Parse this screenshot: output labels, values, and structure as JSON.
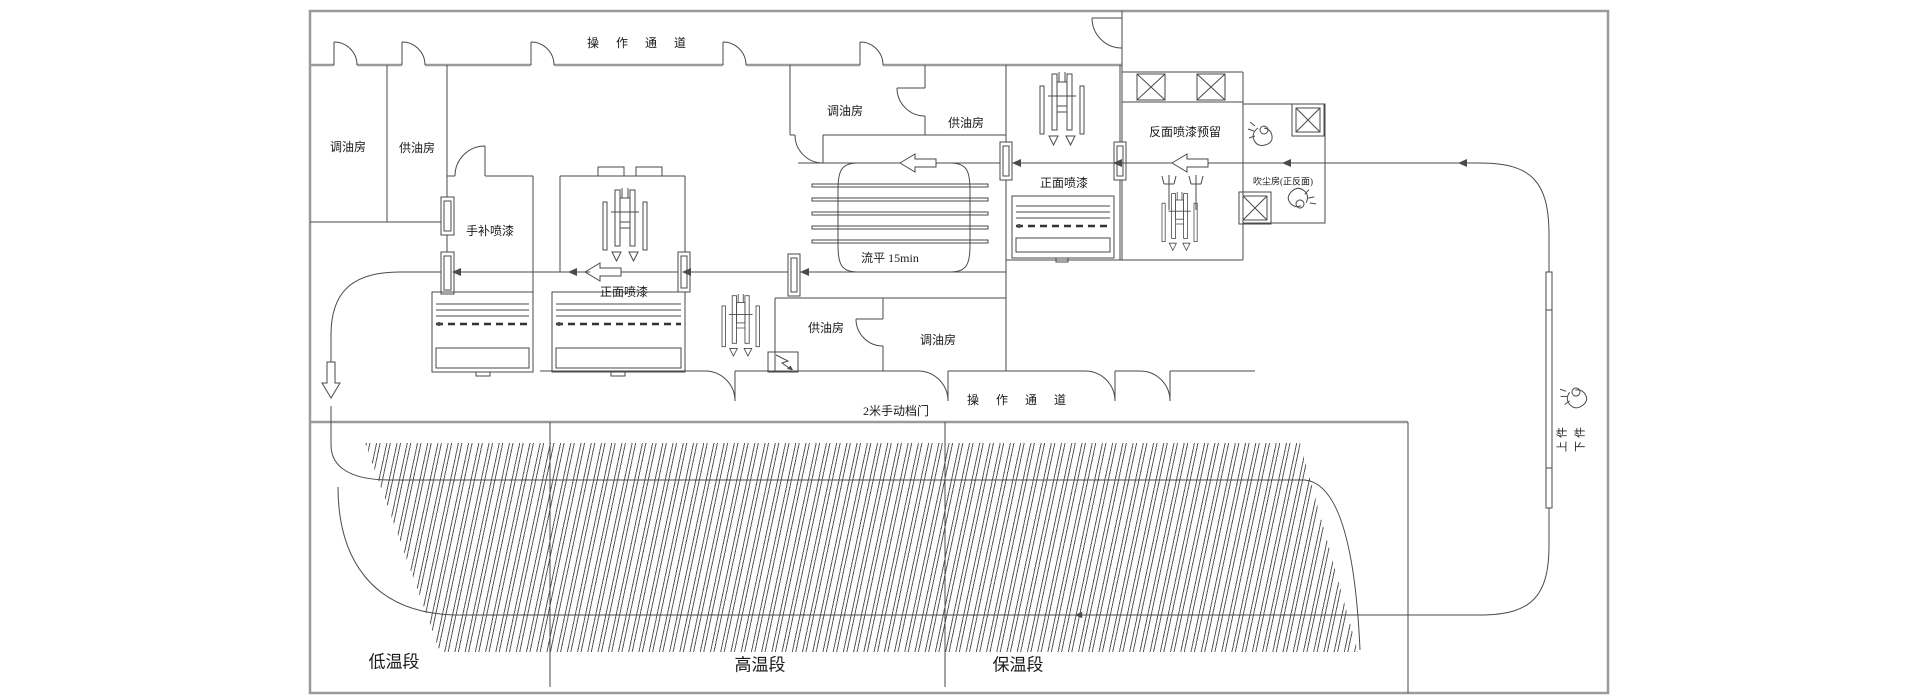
{
  "canvas": {
    "width": 1920,
    "height": 700,
    "background": "#ffffff"
  },
  "colors": {
    "line": "#4a4a4a",
    "wall": "#9a9a9a",
    "text": "#1a1a1a"
  },
  "drawing_type": "paint-shop floor plan (CAD)",
  "labels": {
    "corridor": "操 作 通 道",
    "oil_mix_room": "调油房",
    "oil_supply_room": "供油房",
    "touch_up_spray": "手补喷漆",
    "front_spray": "正面喷漆",
    "back_spray_reserved": "反面喷漆预留",
    "dust_blow_room": "吹尘房(正反面)",
    "leveling": "流平 15min",
    "manual_door": "2米手动档门",
    "low_temp_section": "低温段",
    "high_temp_section": "高温段",
    "hold_temp_section": "保温段",
    "load": "上件",
    "unload": "下件"
  }
}
